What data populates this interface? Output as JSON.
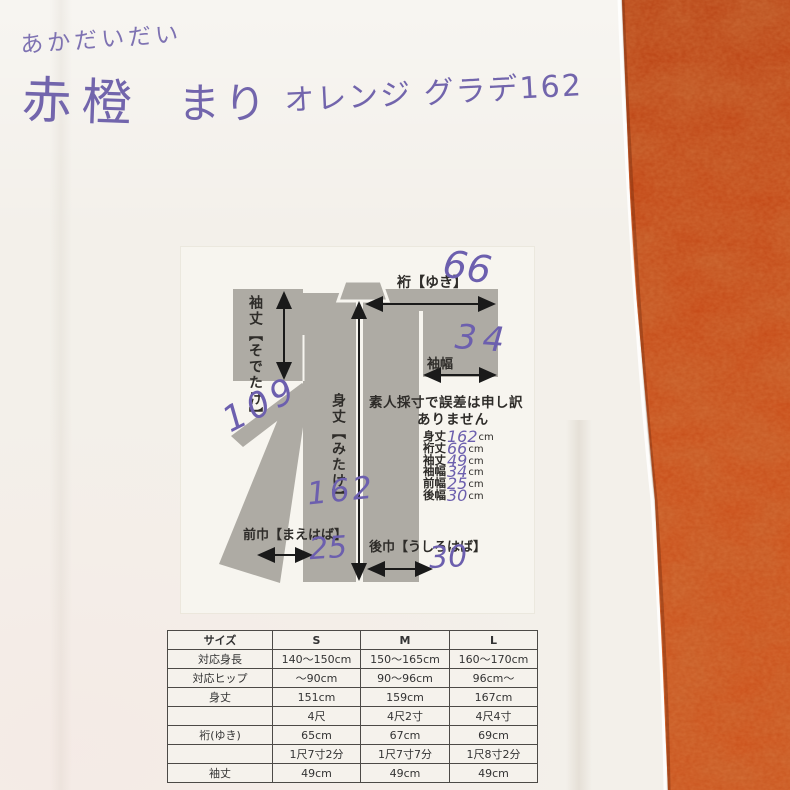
{
  "handwritten_header": {
    "line1": "あかだいだい",
    "color_name": "赤橙",
    "item_name": "まり",
    "note": "オレンジ グラデ162"
  },
  "diagram": {
    "labels": {
      "yuki": "裄【ゆき】",
      "yuki_value": "66",
      "sodetake": "袖丈【そでたけ】",
      "sodehaba": "袖幅",
      "sodehaba_value": "34",
      "mitake": "身丈【みたけ】",
      "mitake_value": "162",
      "maehaba": "前巾【まえはば】",
      "maehaba_value": "25",
      "ushirohaba": "後巾【うしろはば】",
      "ushirohaba_value": "30",
      "collar_note": "109"
    },
    "disclaimer_line1": "素人採寸で誤差は申し訳",
    "disclaimer_line2": "ありません",
    "measurements": [
      {
        "label": "身丈",
        "value": "162",
        "unit": "cm"
      },
      {
        "label": "裄丈",
        "value": "66",
        "unit": "cm"
      },
      {
        "label": "袖丈",
        "value": "49",
        "unit": "cm"
      },
      {
        "label": "袖幅",
        "value": "34",
        "unit": "cm"
      },
      {
        "label": "前幅",
        "value": "25",
        "unit": "cm"
      },
      {
        "label": "後幅",
        "value": "30",
        "unit": "cm"
      }
    ]
  },
  "size_table": {
    "headers": [
      "サイズ",
      "S",
      "M",
      "L"
    ],
    "rows": [
      [
        "対応身長",
        "140〜150cm",
        "150〜165cm",
        "160〜170cm"
      ],
      [
        "対応ヒップ",
        "〜90cm",
        "90〜96cm",
        "96cm〜"
      ],
      [
        "身丈",
        "151cm",
        "159cm",
        "167cm"
      ],
      [
        "",
        "4尺",
        "4尺2寸",
        "4尺4寸"
      ],
      [
        "裄(ゆき)",
        "65cm",
        "67cm",
        "69cm"
      ],
      [
        "",
        "1尺7寸2分",
        "1尺7寸7分",
        "1尺8寸2分"
      ],
      [
        "袖丈",
        "49cm",
        "49cm",
        "49cm"
      ]
    ]
  },
  "colors": {
    "fabric_orange": "#c64512",
    "paper_white": "#f3f0ea",
    "ink_purple": "#6c5fae",
    "kimono_gray": "#aeaba4"
  }
}
